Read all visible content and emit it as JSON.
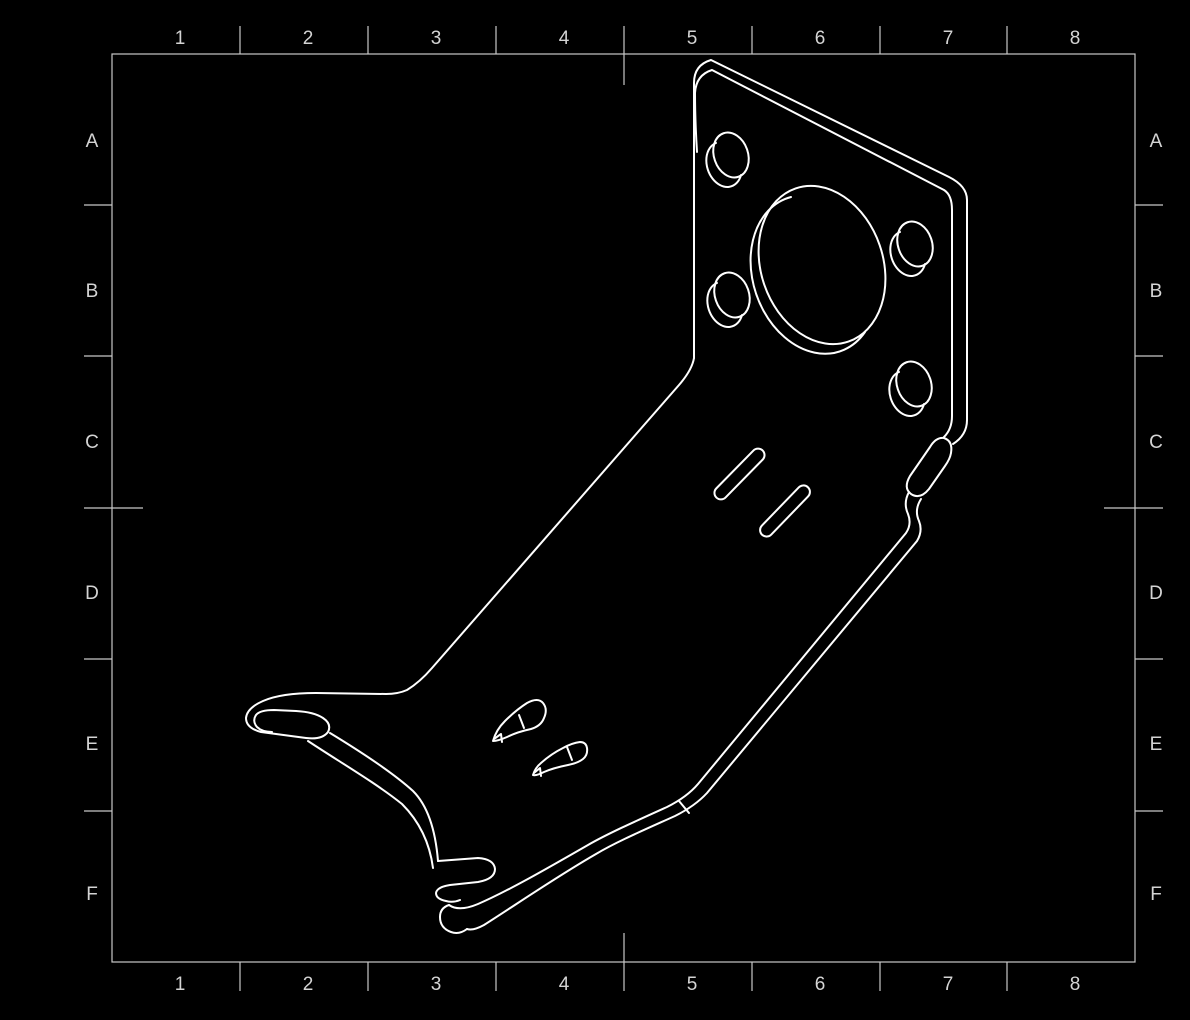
{
  "canvas": {
    "background": "#000000",
    "sheet_line_color": "#c8c8c8",
    "part_line_color": "#ffffff",
    "label_color": "#d4d4d4"
  },
  "sheet_grid": {
    "columns_top": [
      "1",
      "2",
      "3",
      "4",
      "5",
      "6",
      "7",
      "8"
    ],
    "columns_bottom": [
      "1",
      "2",
      "3",
      "4",
      "5",
      "6",
      "7",
      "8"
    ],
    "rows_left": [
      "A",
      "B",
      "C",
      "D",
      "E",
      "F"
    ],
    "rows_right": [
      "A",
      "B",
      "C",
      "D",
      "E",
      "F"
    ]
  }
}
